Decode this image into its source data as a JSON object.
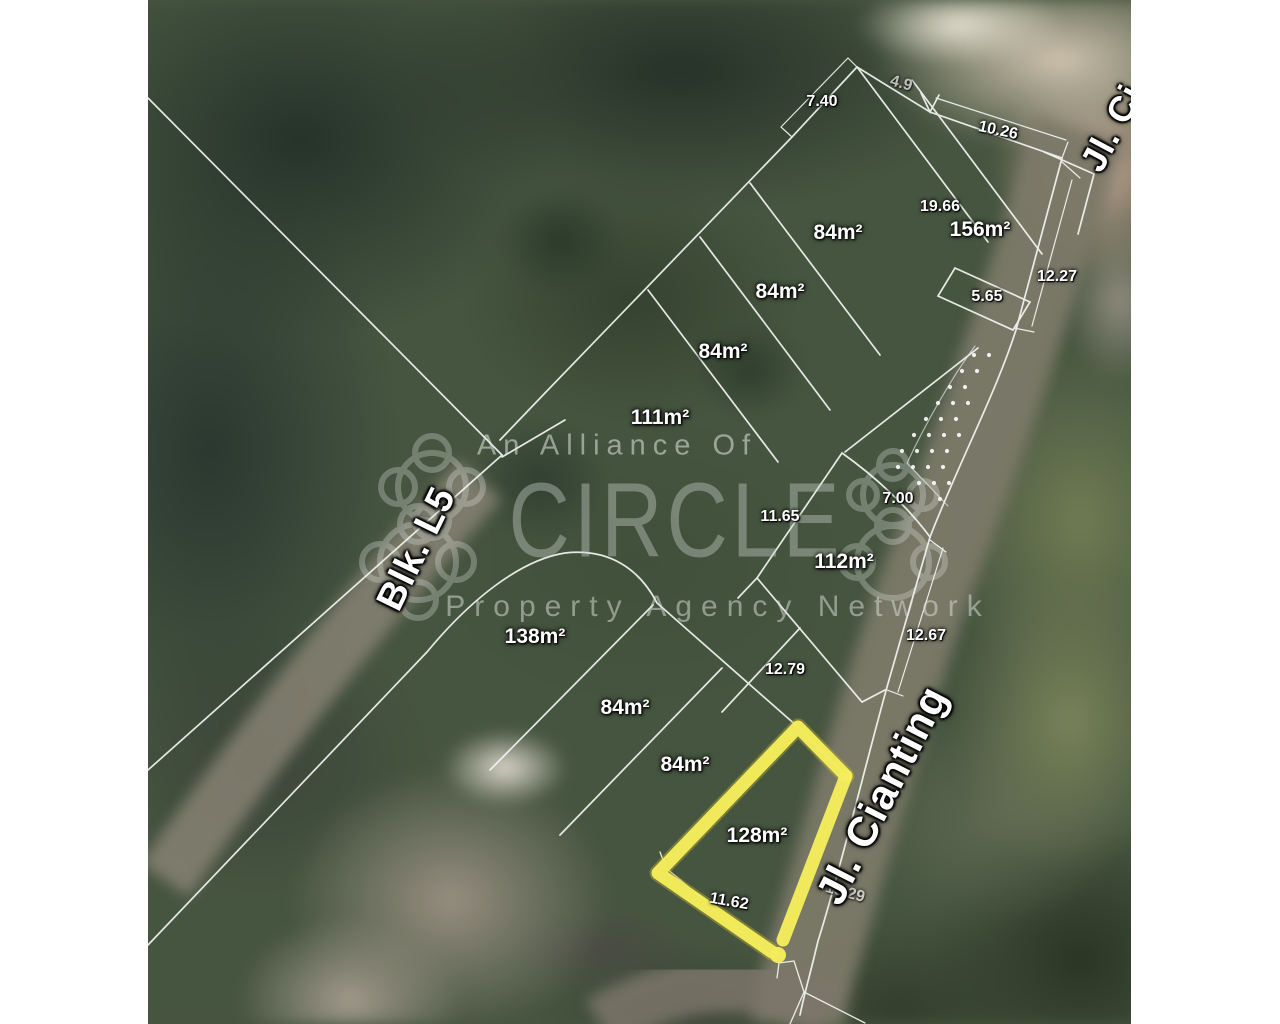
{
  "map": {
    "watermark": {
      "tagline": "An Alliance Of",
      "brand": "CIRCLE",
      "subtitle": "Property Agency Network"
    },
    "highlight": {
      "plot_area": "128m²",
      "outline_color": "#f4ec5c"
    },
    "line_color": "#ffffff",
    "area_labels": [
      {
        "text": "84m²",
        "x": 838,
        "y": 233
      },
      {
        "text": "156m²",
        "x": 980,
        "y": 230
      },
      {
        "text": "84m²",
        "x": 780,
        "y": 292
      },
      {
        "text": "84m²",
        "x": 723,
        "y": 352
      },
      {
        "text": "111m²",
        "x": 660,
        "y": 418
      },
      {
        "text": "112m²",
        "x": 844,
        "y": 562
      },
      {
        "text": "138m²",
        "x": 535,
        "y": 637
      },
      {
        "text": "84m²",
        "x": 625,
        "y": 708
      },
      {
        "text": "84m²",
        "x": 685,
        "y": 765
      },
      {
        "text": "128m²",
        "x": 757,
        "y": 836
      }
    ],
    "dimension_labels": [
      {
        "text": "7.40",
        "x": 822,
        "y": 102,
        "rot": 0
      },
      {
        "text": "4.9",
        "x": 901,
        "y": 84,
        "rot": 15,
        "faded": true
      },
      {
        "text": "10.26",
        "x": 998,
        "y": 131,
        "rot": 12
      },
      {
        "text": "19.66",
        "x": 940,
        "y": 207,
        "rot": 0
      },
      {
        "text": "12.27",
        "x": 1057,
        "y": 277,
        "rot": 0
      },
      {
        "text": "5.65",
        "x": 987,
        "y": 297,
        "rot": 0
      },
      {
        "text": "7.00",
        "x": 898,
        "y": 499,
        "rot": 0
      },
      {
        "text": "11.65",
        "x": 780,
        "y": 517,
        "rot": 0
      },
      {
        "text": "12.67",
        "x": 926,
        "y": 636,
        "rot": 0
      },
      {
        "text": "12.79",
        "x": 785,
        "y": 670,
        "rot": 0
      },
      {
        "text": "11.62",
        "x": 729,
        "y": 902,
        "rot": 10
      },
      {
        "text": "15.29",
        "x": 845,
        "y": 893,
        "rot": 15,
        "faded": true
      }
    ],
    "street_labels": [
      {
        "text": "Jl. Cianting",
        "x": 882,
        "y": 795,
        "rot": -63,
        "size": 42
      },
      {
        "text": "Blk. L5",
        "x": 417,
        "y": 549,
        "rot": -64,
        "size": 38
      },
      {
        "text": "Jl. Ci",
        "x": 1112,
        "y": 128,
        "rot": -62,
        "size": 36
      }
    ]
  }
}
